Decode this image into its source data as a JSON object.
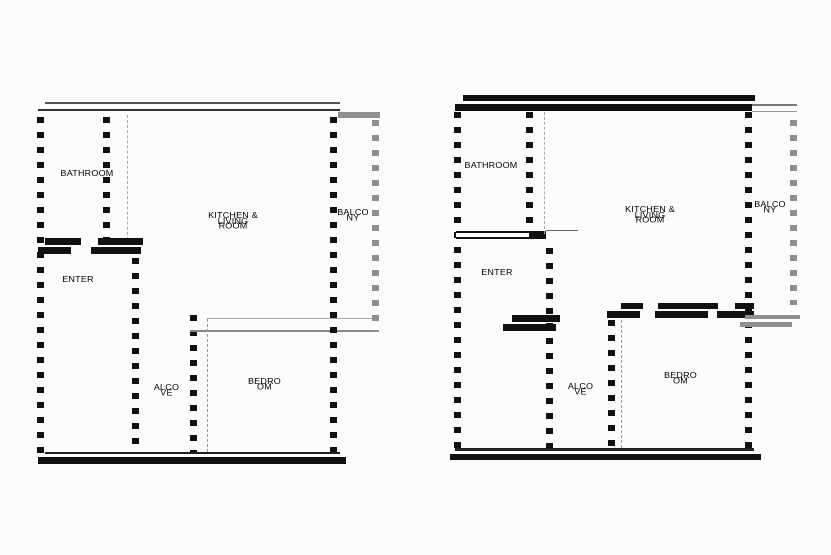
{
  "colors": {
    "wall": "#111111",
    "balcony": "#8f8f8f",
    "bg": "#fcfcfc",
    "line": "#666666"
  },
  "plans": [
    {
      "name": "floor-plan-left",
      "rooms": [
        {
          "key": "bathroom",
          "label": "BATHROOM"
        },
        {
          "key": "kitchen-living",
          "label": "KITCHEN & LIVING ROOM"
        },
        {
          "key": "balcony",
          "label": "BALCONY"
        },
        {
          "key": "enter",
          "label": "ENTER"
        },
        {
          "key": "alcove",
          "label": "ALCOVE"
        },
        {
          "key": "bedroom",
          "label": "BEDROOM"
        }
      ]
    },
    {
      "name": "floor-plan-right",
      "rooms": [
        {
          "key": "bathroom",
          "label": "BATHROOM"
        },
        {
          "key": "kitchen-living",
          "label": "KITCHEN & LIVING ROOM"
        },
        {
          "key": "balcony",
          "label": "BALCONY"
        },
        {
          "key": "enter",
          "label": "ENTER"
        },
        {
          "key": "alcove",
          "label": "ALCOVE"
        },
        {
          "key": "bedroom",
          "label": "BEDROOM"
        }
      ]
    }
  ]
}
